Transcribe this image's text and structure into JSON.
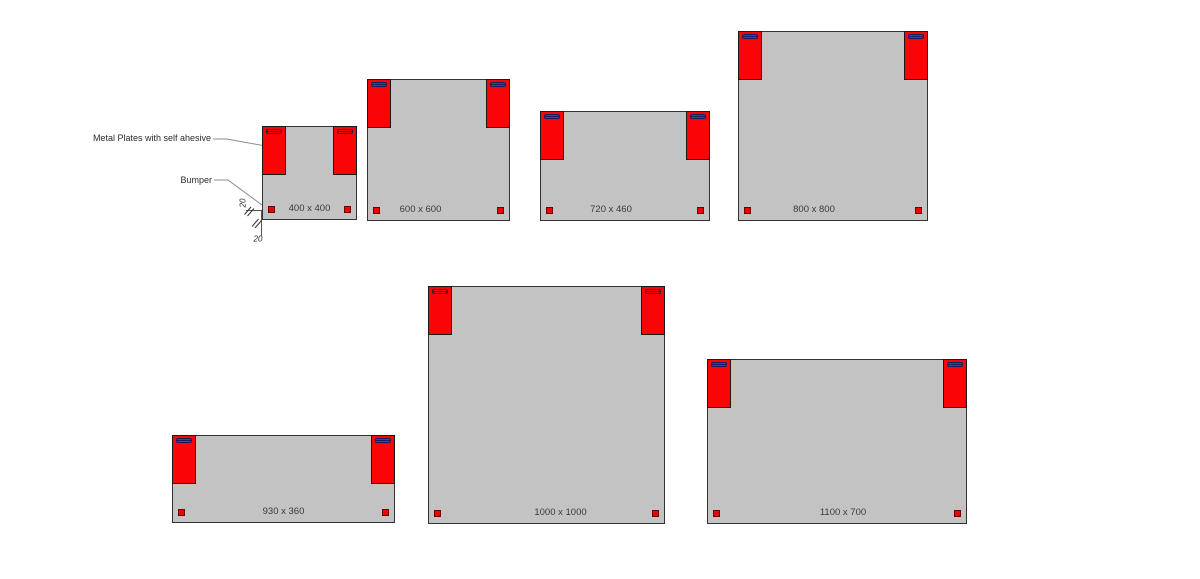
{
  "annotations": {
    "metal_plates_label": "Metal Plates with self ahesive",
    "bumper_label": "Bumper",
    "dim_left_value": "20",
    "dim_bottom_value": "20"
  },
  "panels": [
    {
      "id": "400x400",
      "label": "400 x 400",
      "width_mm": 400,
      "height_mm": 400
    },
    {
      "id": "600x600",
      "label": "600 x 600",
      "width_mm": 600,
      "height_mm": 600
    },
    {
      "id": "720x460",
      "label": "720 x 460",
      "width_mm": 720,
      "height_mm": 460
    },
    {
      "id": "800x800",
      "label": "800 x 800",
      "width_mm": 800,
      "height_mm": 800
    },
    {
      "id": "930x360",
      "label": "930 x 360",
      "width_mm": 930,
      "height_mm": 360
    },
    {
      "id": "1000x1000",
      "label": "1000 x 1000",
      "width_mm": 1000,
      "height_mm": 1000
    },
    {
      "id": "1100x700",
      "label": "1100 x 700",
      "width_mm": 1100,
      "height_mm": 700
    }
  ],
  "colors": {
    "panel_fill": "#c3c3c3",
    "panel_border": "#333333",
    "plate_red": "#f90505",
    "bumper_red": "#f00202",
    "slot_outline": "#1a1a5e",
    "leader_line": "#8c8c8c",
    "dim_line": "#555555"
  }
}
